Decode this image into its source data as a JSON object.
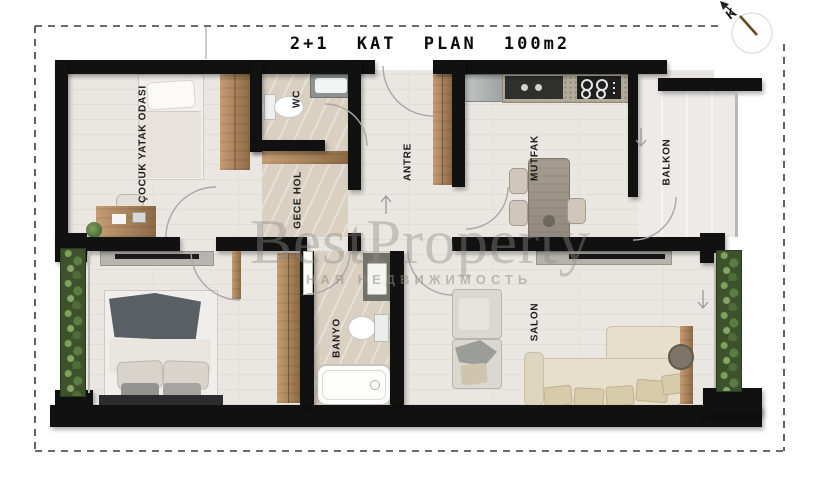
{
  "title": "2+1 KAT PLAN 100m2",
  "compass": {
    "label": "K"
  },
  "rooms": [
    {
      "id": "cocuk-yatak-odasi",
      "label": "ÇOCUK YATAK ODASI"
    },
    {
      "id": "wc",
      "label": "WC"
    },
    {
      "id": "gece-hol",
      "label": "GECE HOL"
    },
    {
      "id": "antre",
      "label": "ANTRE"
    },
    {
      "id": "mutfak",
      "label": "MUTFAK"
    },
    {
      "id": "balkon",
      "label": "BALKON"
    },
    {
      "id": "banyo",
      "label": "BANYO"
    },
    {
      "id": "salon",
      "label": "SALON"
    }
  ],
  "watermark": {
    "brand": "BestProperty",
    "subtitle": "НАЯ НЕДВИЖИМОСТЬ"
  },
  "colors": {
    "wall": "#111111",
    "wood": "#b08a63",
    "plant": "#3c512c",
    "floor": "#eae7e2",
    "tile": "#d9d0c2",
    "balcony_floor": "#edeae8",
    "needle": "#5f4a26"
  }
}
